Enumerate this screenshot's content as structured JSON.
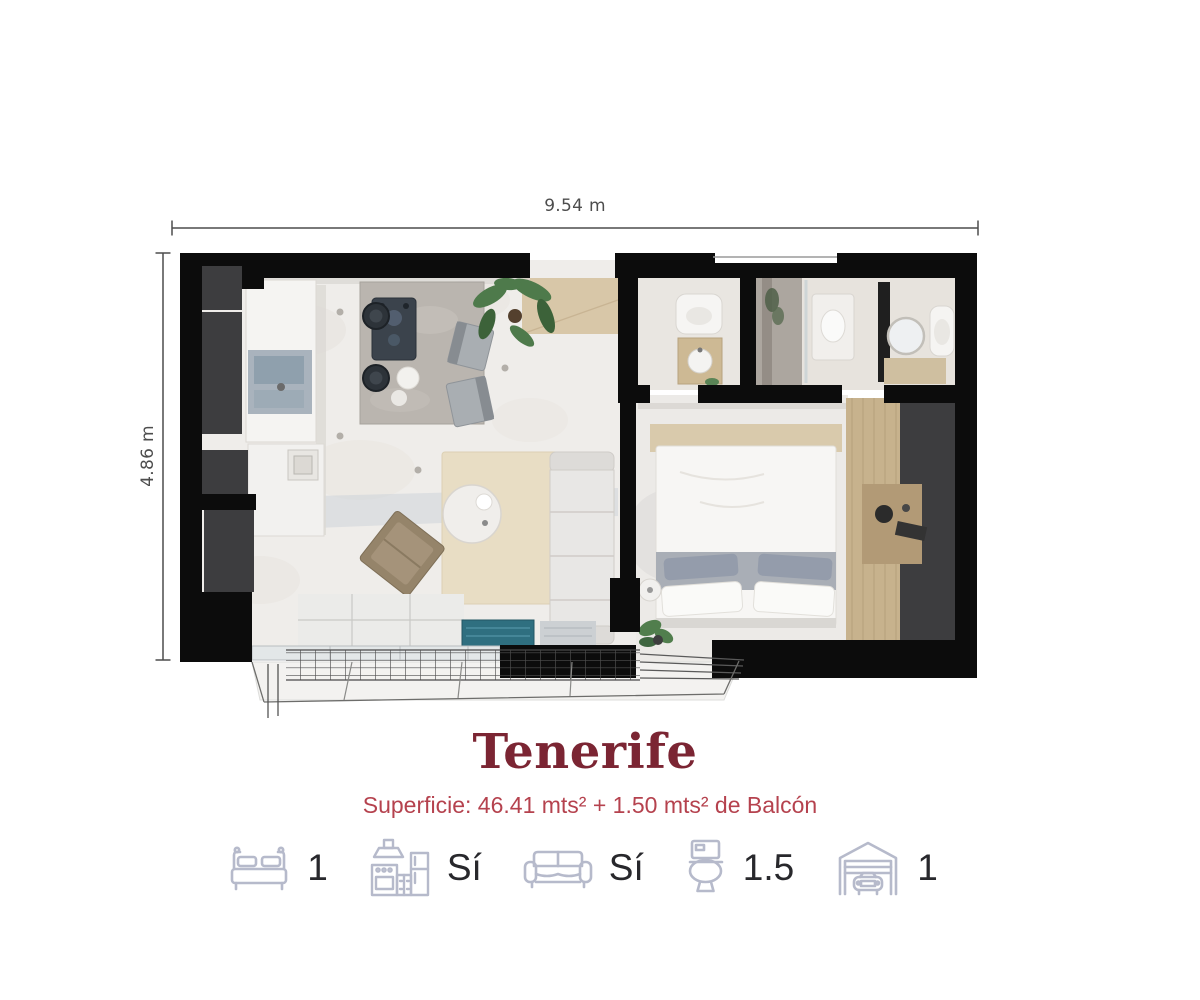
{
  "unit_plan": {
    "title": "Tenerife",
    "subtitle": "Superficie: 46.41 mts² + 1.50 mts² de Balcón"
  },
  "dimensions": {
    "width": "9.54 m",
    "height": "4.86 m"
  },
  "features": [
    {
      "name": "bedrooms",
      "icon": "bed-icon",
      "value": "1"
    },
    {
      "name": "kitchen",
      "icon": "kitchen-icon",
      "value": "Sí"
    },
    {
      "name": "living",
      "icon": "sofa-icon",
      "value": "Sí"
    },
    {
      "name": "bathrooms",
      "icon": "toilet-icon",
      "value": "1.5"
    },
    {
      "name": "parking",
      "icon": "garage-icon",
      "value": "1"
    }
  ],
  "colors": {
    "title": "#7b2533",
    "subtitle": "#b5424e",
    "feature_icon": "#b6bacb",
    "feature_value": "#28282c",
    "dimension_text": "#4d4d4d",
    "wall": "#0c0c0c",
    "closet": "#3d3d3f",
    "floor_marble": "#efedea",
    "floor_wood": "#c7b28d",
    "entry_wood": "#d8c7a8",
    "rug": "#e8ddc4",
    "balcony_mat": "#2f6f80",
    "plant": "#4e7a4b"
  }
}
